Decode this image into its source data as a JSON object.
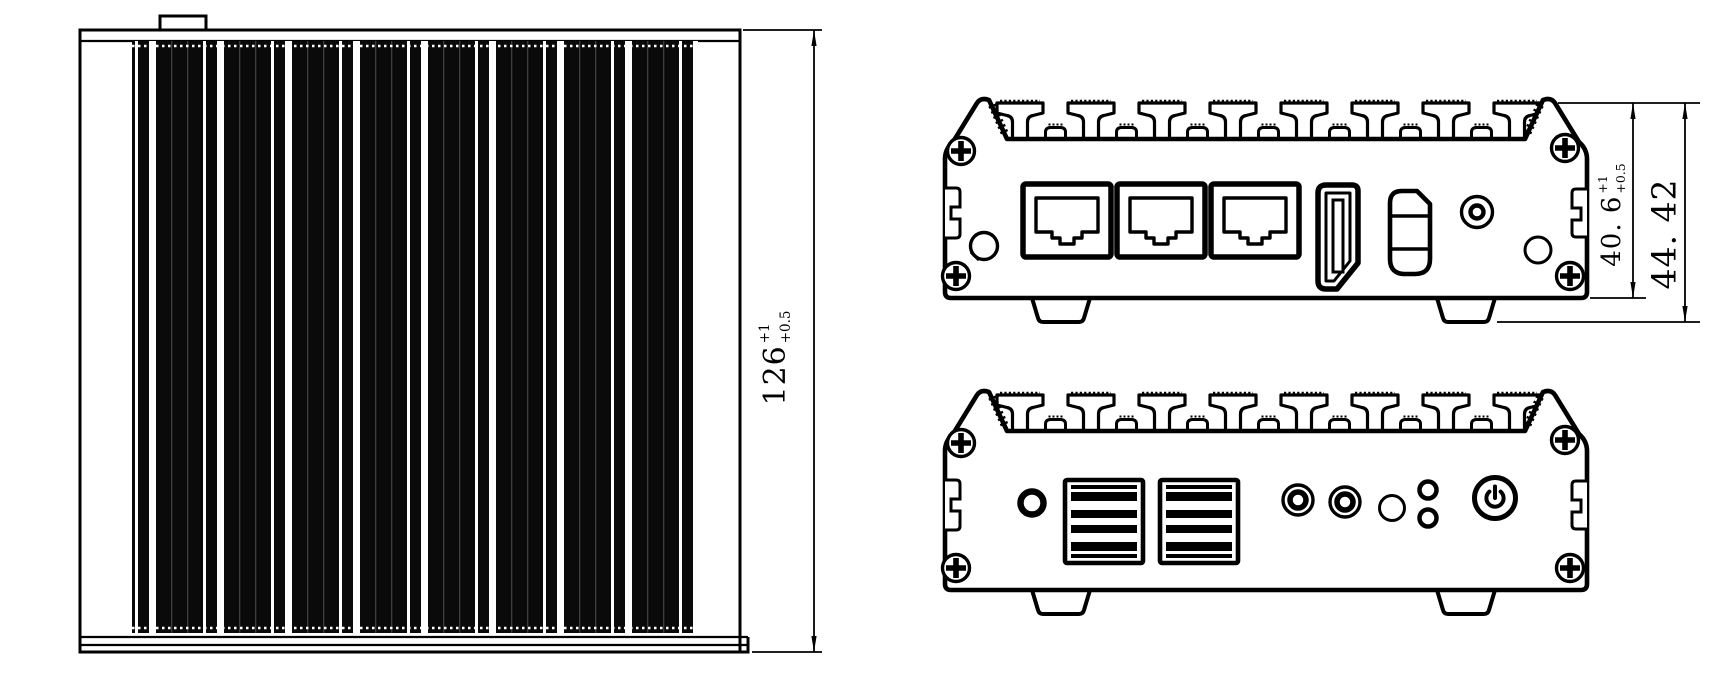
{
  "colors": {
    "line": "#000000",
    "background": "#ffffff"
  },
  "dimensions": {
    "top_view_height": {
      "value": "126",
      "tol_upper": "+1",
      "tol_lower": "+0.5"
    },
    "rear_body_height": {
      "value": "40. 6",
      "tol_upper": "+1",
      "tol_lower": "+0.5"
    },
    "rear_overall_height": {
      "value": "44. 42"
    }
  }
}
